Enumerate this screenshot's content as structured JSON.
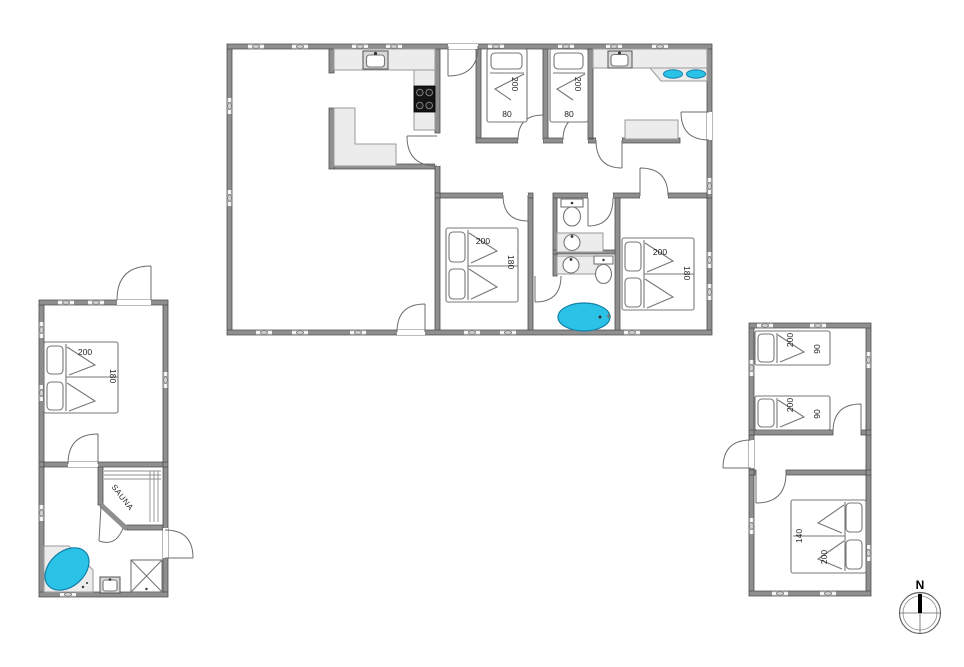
{
  "colors": {
    "wall": "#8f8f8f",
    "wall_edge": "#4d4d4d",
    "fixture_fill": "#ececec",
    "water": "#2bc2e8",
    "water_edge": "#1180a8",
    "stove": "#141414"
  },
  "main_building": {
    "bedroom_a_bed": {
      "length": "200",
      "width": "80"
    },
    "bedroom_b_bed": {
      "length": "200",
      "width": "80"
    },
    "bedroom_c_bed": {
      "length": "200",
      "width": "180"
    },
    "bedroom_d_bed": {
      "length": "200",
      "width": "180"
    }
  },
  "left_annex": {
    "bedroom_bed": {
      "length": "200",
      "width": "180"
    },
    "sauna_label": "SAUNA"
  },
  "right_annex": {
    "bed_1": {
      "length": "200",
      "width": "90"
    },
    "bed_2": {
      "length": "200",
      "width": "90"
    },
    "double_bed": {
      "width": "140",
      "length": "200"
    }
  },
  "compass": {
    "north": "N"
  }
}
